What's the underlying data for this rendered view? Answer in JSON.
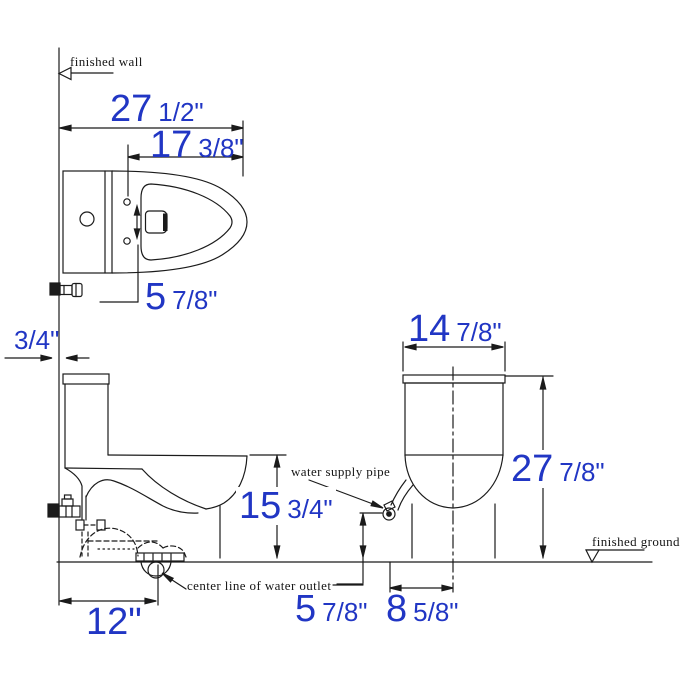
{
  "drawing": {
    "title": "one-piece toilet dimension drawing",
    "colors": {
      "dimension_text": "#2136c4",
      "line": "#1b1b1b",
      "background": "#ffffff"
    }
  },
  "labels": {
    "finished_wall": "finished wall",
    "water_supply_pipe": "water supply pipe",
    "center_line_of_water_outlet": "center line of water outlet",
    "finished_ground": "finished ground"
  },
  "dimensions": {
    "overall_depth": {
      "whole": "27",
      "fraction": "1/2\""
    },
    "seat_depth": {
      "whole": "17",
      "fraction": "3/8\""
    },
    "bolt_spacing": {
      "whole": "5",
      "fraction": "7/8\""
    },
    "wall_gap": {
      "whole": "",
      "fraction": "3/4\""
    },
    "bowl_height": {
      "whole": "15",
      "fraction": "3/4\""
    },
    "rough_in": {
      "whole": "12\"",
      "fraction": ""
    },
    "tank_width": {
      "whole": "14",
      "fraction": "7/8\""
    },
    "overall_height": {
      "whole": "27",
      "fraction": "7/8\""
    },
    "supply_height": {
      "whole": "5",
      "fraction": "7/8\""
    },
    "supply_offset": {
      "whole": "8",
      "fraction": "5/8\""
    }
  }
}
